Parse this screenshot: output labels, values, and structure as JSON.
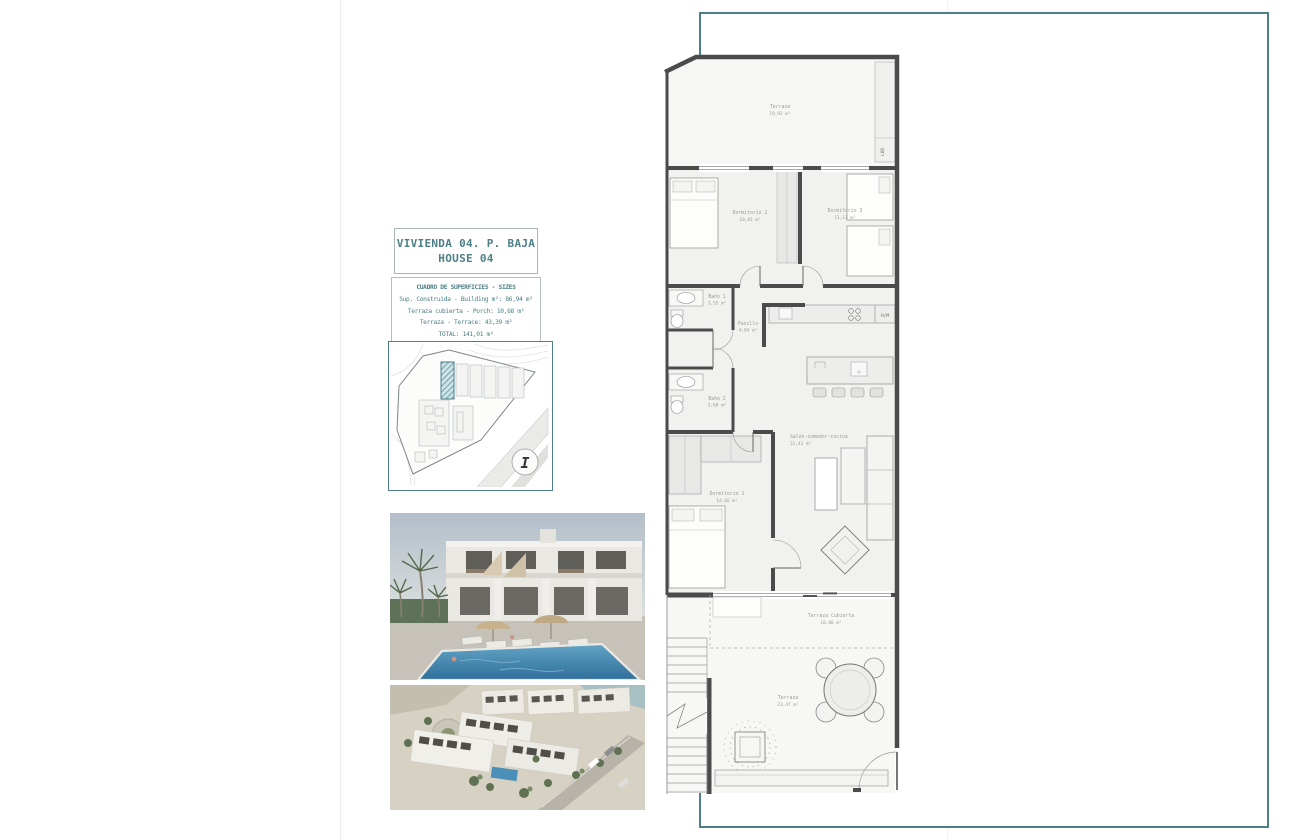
{
  "document": {
    "title_line1": "VIVIENDA 04. P. BAJA",
    "title_line2": "HOUSE 04"
  },
  "surface_table": {
    "header": "CUADRO DE SUPERFICIES  - SIZES",
    "rows": [
      "Sup. Construida  - Building m²: 86,94 m²",
      "Terraza cubierta  - Porch: 10,68 m²",
      "Terraza - Terrace: 43,39 m²",
      "TOTAL:  141,01 m²"
    ]
  },
  "site_plan": {
    "north_marker": "I"
  },
  "floor_plan": {
    "rooms": {
      "terraza_top": {
        "name": "Terraza",
        "area": "19,92 m²"
      },
      "dormitorio2": {
        "name": "Dormitorio 2",
        "area": "10,01 m²"
      },
      "dormitorio3": {
        "name": "Dormitorio 3",
        "area": "11,11 m²"
      },
      "bano1": {
        "name": "Baño 1",
        "area": "3,55 m²"
      },
      "pasillo": {
        "name": "Pasillo",
        "area": "4,04 m²"
      },
      "bano2": {
        "name": "Baño 2",
        "area": "3,60 m²"
      },
      "salon": {
        "name": "Salón-comedor-cocina",
        "area": "31,41 m²"
      },
      "dormitorio1": {
        "name": "Dormitorio 1",
        "area": "14,66 m²"
      },
      "terraza_cubierta": {
        "name": "Terraza Cubierta",
        "area": "10,08 m²"
      },
      "terraza_bottom": {
        "name": "Terraza",
        "area": "23,47 m²"
      }
    },
    "labels": {
      "laundry_column": "LVD",
      "appliance_column": "H/M"
    }
  },
  "colors": {
    "accent_teal": "#4C7F87",
    "wall_gray": "#4B4B4B",
    "label_gray": "#9B9B9B",
    "pool_blue": "#4A90B8",
    "highlight_hatch": "#57939D"
  }
}
